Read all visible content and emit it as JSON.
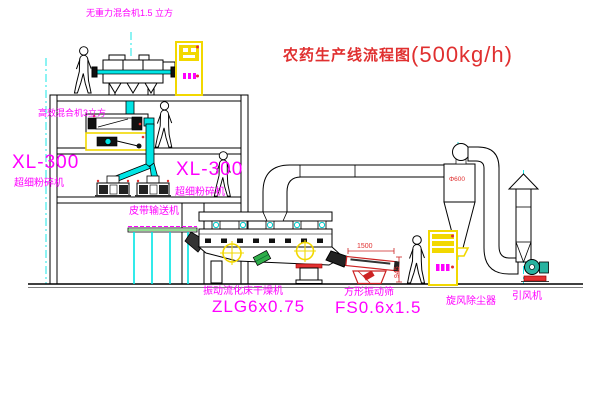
{
  "title": {
    "text": "农药生产线流程图",
    "capacity": "(500kg/h)"
  },
  "equipment": {
    "gravity_mixer": {
      "label": "无重力混合机1.5 立方"
    },
    "high_mixer": {
      "label": "高效混合机3立方"
    },
    "mill_left": {
      "model": "XL-300",
      "label": "超细粉碎机"
    },
    "mill_right": {
      "model": "XL-300",
      "label": "超细粉碎机"
    },
    "conveyor": {
      "label": "皮带输送机"
    },
    "dryer": {
      "label": "振动流化床干燥机",
      "model": "ZLG6x0.75"
    },
    "screen": {
      "label": "方形振动筛",
      "model": "FS0.6x1.5"
    },
    "cyclone": {
      "label": "旋风除尘器"
    },
    "fan": {
      "label": "引风机"
    }
  },
  "dimensions": {
    "screen_length": "1500",
    "screen_height": "945",
    "cyclone_dia": "Φ600"
  },
  "colors": {
    "label_magenta": "#ff00ff",
    "title_red": "#e03030",
    "line_black": "#000000",
    "pipe_cyan": "#00e5e5",
    "highlight_yellow": "#f2d800",
    "accent_red": "#e23030",
    "fan_teal": "#29b3a0",
    "green": "#2fae4a"
  }
}
